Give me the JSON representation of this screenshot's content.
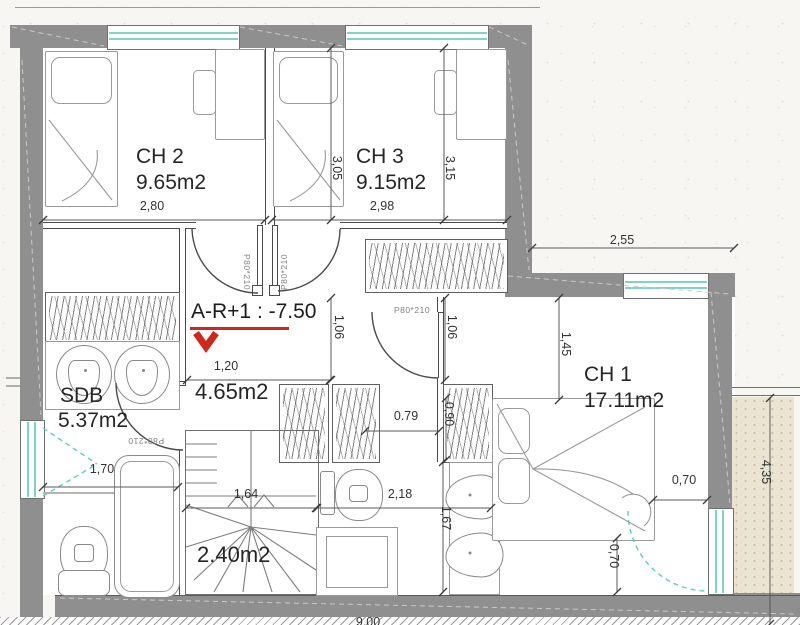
{
  "drawing": {
    "level_marker": "A-R+1 : -7.50",
    "rooms": {
      "ch1": {
        "name": "CH 1",
        "area": "17.11m2"
      },
      "ch2": {
        "name": "CH 2",
        "area": "9.65m2"
      },
      "ch3": {
        "name": "CH 3",
        "area": "9.15m2"
      },
      "sdb": {
        "name": "SDB",
        "area": "5.37m2"
      },
      "hall": {
        "area": "4.65m2"
      },
      "stairs": {
        "area": "2.40m2"
      }
    },
    "door_tags": [
      {
        "text": "P80*210",
        "x": 247,
        "y": 272,
        "rot": 90
      },
      {
        "text": "P80*210",
        "x": 284,
        "y": 272,
        "rot": -90
      },
      {
        "text": "P80*210",
        "x": 412,
        "y": 310,
        "rot": 0
      },
      {
        "text": "P80*210",
        "x": 146,
        "y": 441,
        "rot": 180
      }
    ],
    "dimensions": [
      {
        "label": "2,80",
        "x": 152,
        "y": 206,
        "rot": 0,
        "line": [
          43,
          220,
          265,
          220
        ]
      },
      {
        "label": "2,98",
        "x": 382,
        "y": 206,
        "rot": 0,
        "line": [
          272,
          220,
          507,
          220
        ]
      },
      {
        "label": "3,05",
        "x": 337,
        "y": 168,
        "rot": 90,
        "line": [
          331,
          48,
          331,
          220
        ]
      },
      {
        "label": "3,15",
        "x": 450,
        "y": 168,
        "rot": 90,
        "line": [
          444,
          48,
          444,
          220
        ]
      },
      {
        "label": "2,55",
        "x": 622,
        "y": 240,
        "rot": 0,
        "line": [
          532,
          248,
          734,
          248
        ]
      },
      {
        "label": "1,45",
        "x": 566,
        "y": 344,
        "rot": 90,
        "line": [
          559,
          298,
          559,
          400
        ]
      },
      {
        "label": "1,06",
        "x": 339,
        "y": 327,
        "rot": 90,
        "line": [
          331,
          298,
          331,
          380
        ]
      },
      {
        "label": "1,06",
        "x": 452,
        "y": 327,
        "rot": 90,
        "line": [
          445,
          298,
          445,
          380
        ]
      },
      {
        "label": "1,20",
        "x": 226,
        "y": 366,
        "rot": 0,
        "line": [
          187,
          380,
          330,
          380
        ]
      },
      {
        "label": "0.79",
        "x": 406,
        "y": 416,
        "rot": 0,
        "line": [
          365,
          431,
          439,
          431
        ]
      },
      {
        "label": "0,90",
        "x": 449,
        "y": 414,
        "rot": 90,
        "line": [
          446,
          398,
          446,
          460
        ]
      },
      {
        "label": "1,70",
        "x": 102,
        "y": 469,
        "rot": 0,
        "line": [
          43,
          487,
          178,
          487
        ]
      },
      {
        "label": "1,64",
        "x": 246,
        "y": 494,
        "rot": 0,
        "line": [
          186,
          508,
          316,
          508
        ]
      },
      {
        "label": "2,18",
        "x": 400,
        "y": 494,
        "rot": 0,
        "line": [
          317,
          508,
          491,
          508
        ]
      },
      {
        "label": "1,67",
        "x": 446,
        "y": 518,
        "rot": 90,
        "line": [
          443,
          462,
          443,
          592
        ]
      },
      {
        "label": "0,70",
        "x": 684,
        "y": 480,
        "rot": 0,
        "line": [
          653,
          500,
          707,
          500
        ]
      },
      {
        "label": "0,70",
        "x": 614,
        "y": 556,
        "rot": 90,
        "line": [
          617,
          538,
          617,
          592
        ]
      },
      {
        "label": "4,35",
        "x": 766,
        "y": 472,
        "rot": 90,
        "line": [
          770,
          398,
          770,
          624
        ]
      },
      {
        "label": "9,00",
        "x": 368,
        "y": 622,
        "rot": 0,
        "line": null
      }
    ],
    "colors": {
      "wall": "#8f8f8f",
      "window_glass": "#7fd4ca",
      "marker_red": "#cf271d",
      "ink": "#3c3c3c",
      "exterior_band": "#ece4d2"
    }
  }
}
